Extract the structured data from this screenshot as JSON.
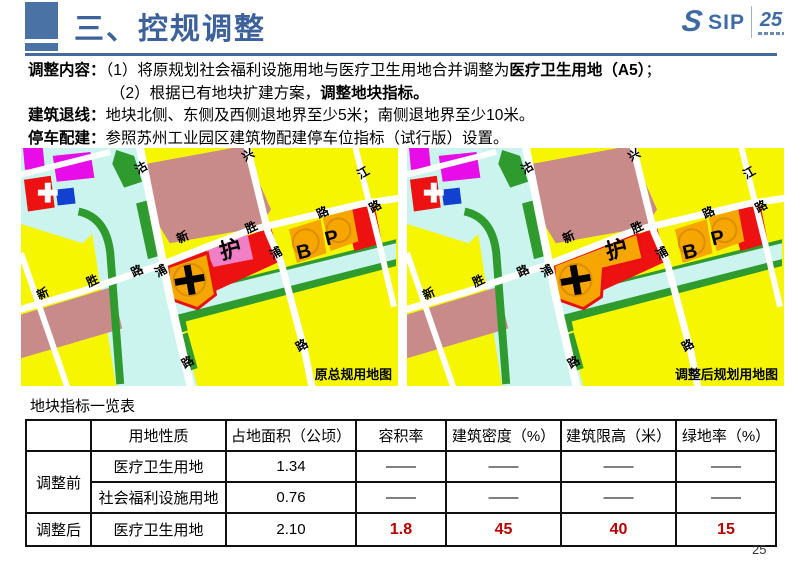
{
  "header": {
    "title": "三、控规调整",
    "logo": {
      "s": "S",
      "sip": "SIP",
      "anniv": "25"
    }
  },
  "content": {
    "line1_label": "调整内容：",
    "line1_text": "（1）将原规划社会福利设施用地与医疗卫生用地合并调整为",
    "line1_bold": "医疗卫生用地（A5）",
    "line1_tail": "；",
    "line2_text": "（2）根据已有地块扩建方案，",
    "line2_bold": "调整地块指标。",
    "line3_label": "建筑退线：",
    "line3_text": "地块北侧、东侧及西侧退地界至少5米；南侧退地界至少10米。",
    "line4_label": "停车配建：",
    "line4_text": "参照苏州工业园区建筑物配建停车位指标（试行版）设置。"
  },
  "maps": {
    "before_caption": "原总规用地图",
    "after_caption": "调整后规划用地图",
    "labels": {
      "gu": "沽",
      "pu": "浦",
      "lu": "路",
      "xing": "兴",
      "jiang": "江",
      "xin": "新",
      "sheng": "胜",
      "hu": "护",
      "b": "B",
      "p": "P"
    }
  },
  "table": {
    "title": "地块指标一览表",
    "headers": [
      "",
      "用地性质",
      "占地面积（公顷）",
      "容积率",
      "建筑密度（%）",
      "建筑限高（米）",
      "绿地率（%）"
    ],
    "groups": [
      {
        "label": "调整前",
        "rows": [
          {
            "type": "医疗卫生用地",
            "area": "1.34",
            "far": "——",
            "density": "——",
            "height": "——",
            "green": "——"
          },
          {
            "type": "社会福利设施用地",
            "area": "0.76",
            "far": "——",
            "density": "——",
            "height": "——",
            "green": "——"
          }
        ]
      },
      {
        "label": "调整后",
        "rows": [
          {
            "type": "医疗卫生用地",
            "area": "2.10",
            "far": "1.8",
            "density": "45",
            "height": "40",
            "green": "15"
          }
        ]
      }
    ]
  },
  "page_number": "25",
  "colors": {
    "accent_blue": "#44699D",
    "highlight_red": "#B90000",
    "map_yellow": "#F6F600",
    "map_water": "#CBF4EF",
    "map_green": "#2F9B2F",
    "map_salmon": "#C98A8A",
    "map_orange": "#F7A600",
    "map_red": "#EE1111",
    "map_pink": "#F07FC5"
  }
}
